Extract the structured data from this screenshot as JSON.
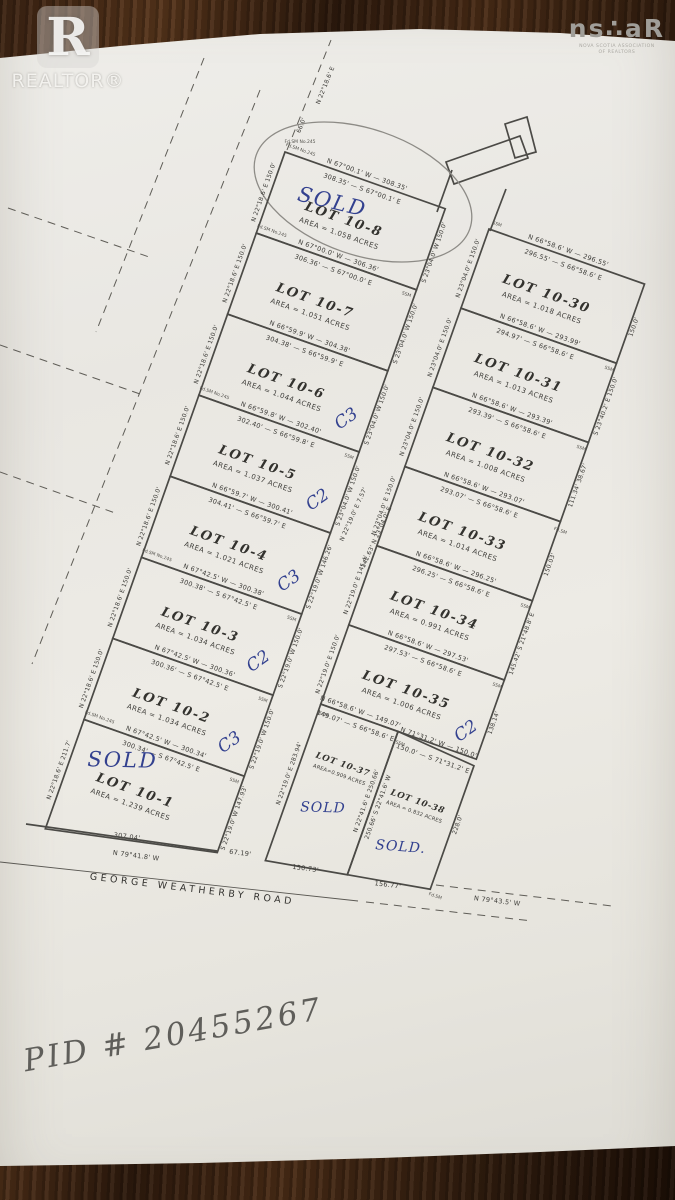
{
  "logos": {
    "realtor_r": "R",
    "realtor_text": "REALTOR®",
    "nsar_main": "ns∴aR",
    "nsar_sub1": "NOVA SCOTIA ASSOCIATION",
    "nsar_sub2": "OF REALTORS"
  },
  "scene": {
    "pid_handwritten": "PID # 20455267"
  },
  "plat": {
    "markers": {
      "ssm": "SSM",
      "fdsm": "Fd.SM",
      "fdsm_no": "Fd.SM No.245"
    },
    "road_top": {
      "bearing": "N 22°18.6' E",
      "width_label": "66.0'"
    },
    "mid_road": {
      "l1": "N 22°19.0' E  7.57'",
      "l2": "142.63'  N 23°04.0' E"
    },
    "george_weatherby": {
      "name": "GEORGE WEATHERBY ROAD",
      "left_dist": "307.04'",
      "left_bearing": "N 79°41.8' W",
      "junction_dist": "67.19'",
      "right_bearing": "N 79°43.5' W"
    },
    "lots_left": [
      {
        "name": "LOT 10-8",
        "area": "AREA = 1.058 ACRES",
        "mark": "SOLD",
        "side_l": "N 22°18.6' E  150.0'",
        "side_r": "S 23°04.0' W  150.0'"
      },
      {
        "name": "LOT 10-7",
        "area": "AREA = 1.051 ACRES",
        "mark": "",
        "side_l": "N 22°18.6' E  150.0'",
        "side_r": "S 23°04.0' W  150.0'"
      },
      {
        "name": "LOT 10-6",
        "area": "AREA = 1.044 ACRES",
        "mark": "C3",
        "side_l": "N 22°18.6' E  150.0'",
        "side_r": "S 23°04.0' W  150.0'"
      },
      {
        "name": "LOT 10-5",
        "area": "AREA = 1.037 ACRES",
        "mark": "C2",
        "side_l": "N 22°18.6' E  150.0'",
        "side_r": "S 23°04.0' W  150.0'"
      },
      {
        "name": "LOT 10-4",
        "area": "AREA = 1.021 ACRES",
        "mark": "C3",
        "side_l": "N 22°18.6' E  150.0'",
        "side_r": "S 22°19.0' W  146.26'"
      },
      {
        "name": "LOT 10-3",
        "area": "AREA = 1.034 ACRES",
        "mark": "C2",
        "side_l": "N 22°18.6' E  150.0'",
        "side_r": "S 22°19.0' W  150.0'"
      },
      {
        "name": "LOT 10-2",
        "area": "AREA = 1.034 ACRES",
        "mark": "C3",
        "side_l": "N 22°18.6' E  150.0'",
        "side_r": "S 22°19.0' W  150.0'"
      },
      {
        "name": "LOT 10-1",
        "area": "AREA = 1.239 ACRES",
        "mark": "SOLD",
        "side_l": "N 22°18.6' E  211.7'",
        "side_r": "S 22°19.0' W  147.93'"
      }
    ],
    "bounds_left": [
      {
        "n": "N 67°00.1' W — 308.35'",
        "s": "308.35' — S 67°00.1' E"
      },
      {
        "n": "N 67°00.0' W — 306.36'",
        "s": "306.36' — S 67°00.0' E"
      },
      {
        "n": "N 66°59.9' W — 304.38'",
        "s": "304.38' — S 66°59.9' E"
      },
      {
        "n": "N 66°59.8' W — 302.40'",
        "s": "302.40' — S 66°59.8' E"
      },
      {
        "n": "N 66°59.7' W — 300.41'",
        "s": "304.41' — S 66°59.7' E"
      },
      {
        "n": "N 67°42.5' W — 300.38'",
        "s": "300.38' — S 67°42.5' E"
      },
      {
        "n": "N 67°42.5' W — 300.36'",
        "s": "300.36' — S 67°42.5' E"
      },
      {
        "n": "N 67°42.5' W — 300.34'",
        "s": "300.34' — S 67°42.5' E"
      }
    ],
    "lots_right": [
      {
        "name": "LOT 10-30",
        "area": "AREA = 1.018 ACRES",
        "mark": "",
        "side_l": "N 23°04.0' E  150.0'",
        "side_r": "150.0'"
      },
      {
        "name": "LOT 10-31",
        "area": "AREA = 1.013 ACRES",
        "mark": "",
        "side_l": "N 23°04.0' E  150.0'",
        "side_r": "S 23°40.2' E  150.0'"
      },
      {
        "name": "LOT 10-32",
        "area": "AREA = 1.008 ACRES",
        "mark": "",
        "side_l": "N 23°04.0' E  150.0'",
        "side_r": "111.34'  38.67'"
      },
      {
        "name": "LOT 10-33",
        "area": "AREA = 1.014 ACRES",
        "mark": "",
        "side_l": "N 23°04.0' E  150.0'",
        "side_r": "150.03'"
      },
      {
        "name": "LOT 10-34",
        "area": "AREA = 0.991 ACRES",
        "mark": "",
        "side_l": "N 22°19.0' E  145.4'",
        "side_r": "145.42'  S 21°48.8' E"
      },
      {
        "name": "LOT 10-35",
        "area": "AREA = 1.006 ACRES",
        "mark": "C2",
        "side_l": "N 22°19.0' E  150.0'",
        "side_r": "138.14'"
      }
    ],
    "bounds_right": [
      {
        "n": "N 66°58.6' W — 296.55'",
        "s": "296.55' — S 66°58.6' E"
      },
      {
        "n": "N 66°58.6' W — 293.99'",
        "s": "294.97' — S 66°58.6' E"
      },
      {
        "n": "N 66°58.6' W — 293.39'",
        "s": "293.39' — S 66°58.6' E"
      },
      {
        "n": "N 66°58.6' W — 293.07'",
        "s": "293.07' — S 66°58.6' E"
      },
      {
        "n": "N 66°58.6' W — 296.25'",
        "s": "296.25' — S 66°58.6' E"
      },
      {
        "n": "N 66°58.6' W — 297.53'",
        "s": "297.53' — S 66°58.6' E"
      },
      {
        "n": "N 66°58.6' W — 149.07'",
        "s": "149.07' — S 66°58.6' E"
      },
      {
        "n": "N 71°31.2' W — 150.0'",
        "s": "150.0' — S 71°31.2' E"
      }
    ],
    "lots_bottom": [
      {
        "name": "LOT 10-37",
        "area": "AREA=0.909 ACRES",
        "mark": "SOLD",
        "side_l": "N 22°19.0' E  283.94'",
        "side_r": "N 22°41.6' E  250.66'",
        "frontage": "150.73'"
      },
      {
        "name": "LOT 10-38",
        "area": "AREA = 0.832 ACRES",
        "mark": "SOLD.",
        "side_l": "250.66'  S 22°41.6' W",
        "side_r": "228.0'",
        "frontage": "156.77'"
      }
    ]
  }
}
